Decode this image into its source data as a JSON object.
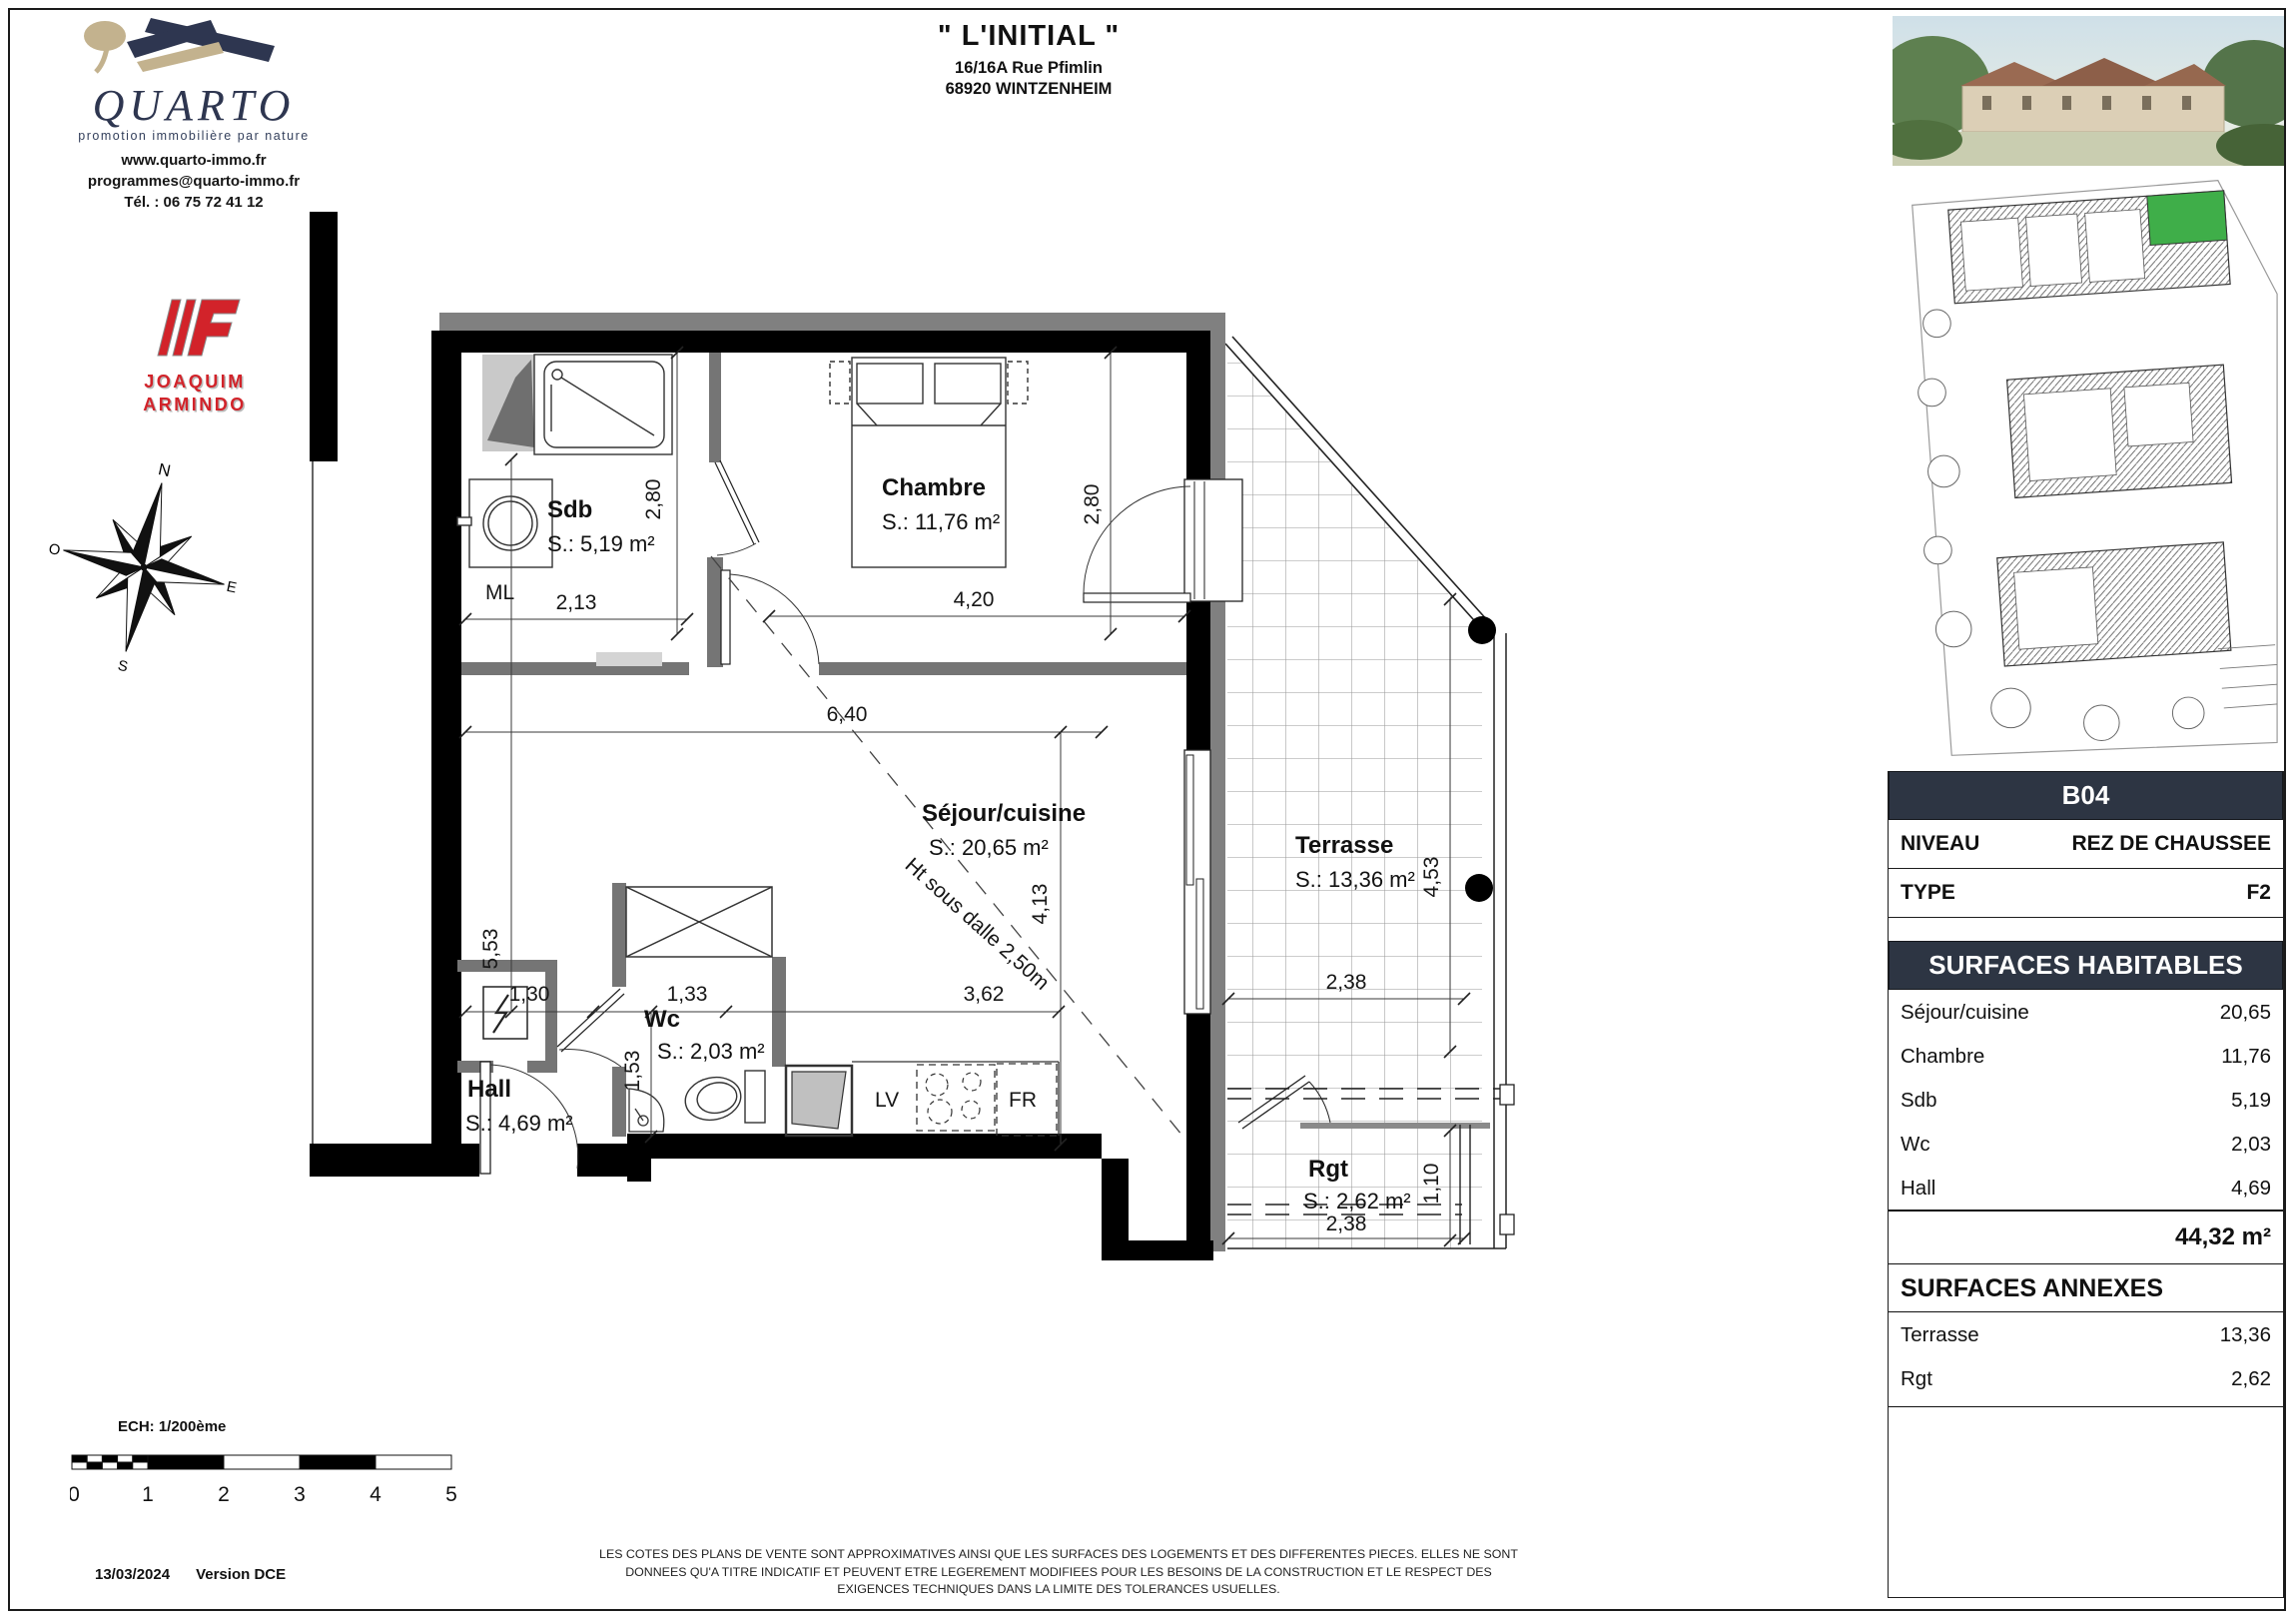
{
  "header": {
    "title": "\" L'INITIAL \"",
    "address1": "16/16A Rue Pfimlin",
    "address2": "68920 WINTZENHEIM"
  },
  "brand": {
    "name": "QUARTO",
    "tagline": "promotion immobilière par nature",
    "website": "www.quarto-immo.fr",
    "email": "programmes@quarto-immo.fr",
    "phone": "Tél. : 06 75 72 41 12",
    "partner1": "JOAQUIM",
    "partner2": "ARMINDO"
  },
  "compass": {
    "n": "N",
    "e": "E",
    "s": "S",
    "o": "O"
  },
  "plan": {
    "rooms": {
      "sdb": {
        "name": "Sdb",
        "area": "S.: 5,19 m²"
      },
      "chambre": {
        "name": "Chambre",
        "area": "S.: 11,76 m²"
      },
      "sejour": {
        "name": "Séjour/cuisine",
        "area": "S.: 20,65 m²"
      },
      "wc": {
        "name": "Wc",
        "area": "S.: 2,03 m²"
      },
      "hall": {
        "name": "Hall",
        "area": "S.: 4,69 m²"
      },
      "terrasse": {
        "name": "Terrasse",
        "area": "S.: 13,36 m²"
      },
      "rgt": {
        "name": "Rgt",
        "area": "S.: 2,62 m²"
      }
    },
    "appliances": {
      "ml": "ML",
      "lv": "LV",
      "fr": "FR"
    },
    "note": "Ht sous dalle 2,50m",
    "dims": {
      "sdb_w": "2,13",
      "sdb_h": "2,80",
      "chambre_w": "4,20",
      "chambre_h": "2,80",
      "sejour_w": "6,40",
      "sejour_h": "4,13",
      "left_h": "5,53",
      "hall_w": "1,30",
      "wc_w": "1,33",
      "wc_h": "1,53",
      "kitchen_w": "3,62",
      "terrasse_w": "2,38",
      "terrasse_h": "4,53",
      "rgt_w": "2,38",
      "rgt_h": "1,10"
    }
  },
  "unit": {
    "id": "B04",
    "rows": [
      {
        "label": "NIVEAU",
        "value": "REZ DE CHAUSSEE"
      },
      {
        "label": "TYPE",
        "value": "F2"
      }
    ]
  },
  "habitables": {
    "title": "SURFACES HABITABLES",
    "rows": [
      {
        "label": "Séjour/cuisine",
        "value": "20,65"
      },
      {
        "label": "Chambre",
        "value": "11,76"
      },
      {
        "label": "Sdb",
        "value": "5,19"
      },
      {
        "label": "Wc",
        "value": "2,03"
      },
      {
        "label": "Hall",
        "value": "4,69"
      }
    ],
    "total": "44,32 m²"
  },
  "annexes": {
    "title": "SURFACES ANNEXES",
    "rows": [
      {
        "label": "Terrasse",
        "value": "13,36"
      },
      {
        "label": "Rgt",
        "value": "2,62"
      }
    ]
  },
  "scalebar": {
    "label": "ECH: 1/200ème",
    "ticks": [
      "0",
      "1",
      "2",
      "3",
      "4",
      "5"
    ]
  },
  "footer": {
    "date": "13/03/2024",
    "version": "Version DCE",
    "line1": "LES COTES DES PLANS DE VENTE SONT APPROXIMATIVES AINSI QUE LES SURFACES DES LOGEMENTS ET DES DIFFERENTES PIECES. ELLES NE SONT",
    "line2": "DONNEES QU'A TITRE INDICATIF ET PEUVENT ETRE LEGEREMENT MODIFIEES POUR LES BESOINS DE LA CONSTRUCTION ET LE RESPECT DES",
    "line3": "EXIGENCES TECHNIQUES DANS LA LIMITE DES TOLERANCES USUELLES."
  },
  "colors": {
    "accent_dark": "#2d3543",
    "brand_navy": "#2e3650",
    "brand_beige": "#c3b28e",
    "partner_red": "#d2232a",
    "highlight_green": "#3fae49"
  }
}
